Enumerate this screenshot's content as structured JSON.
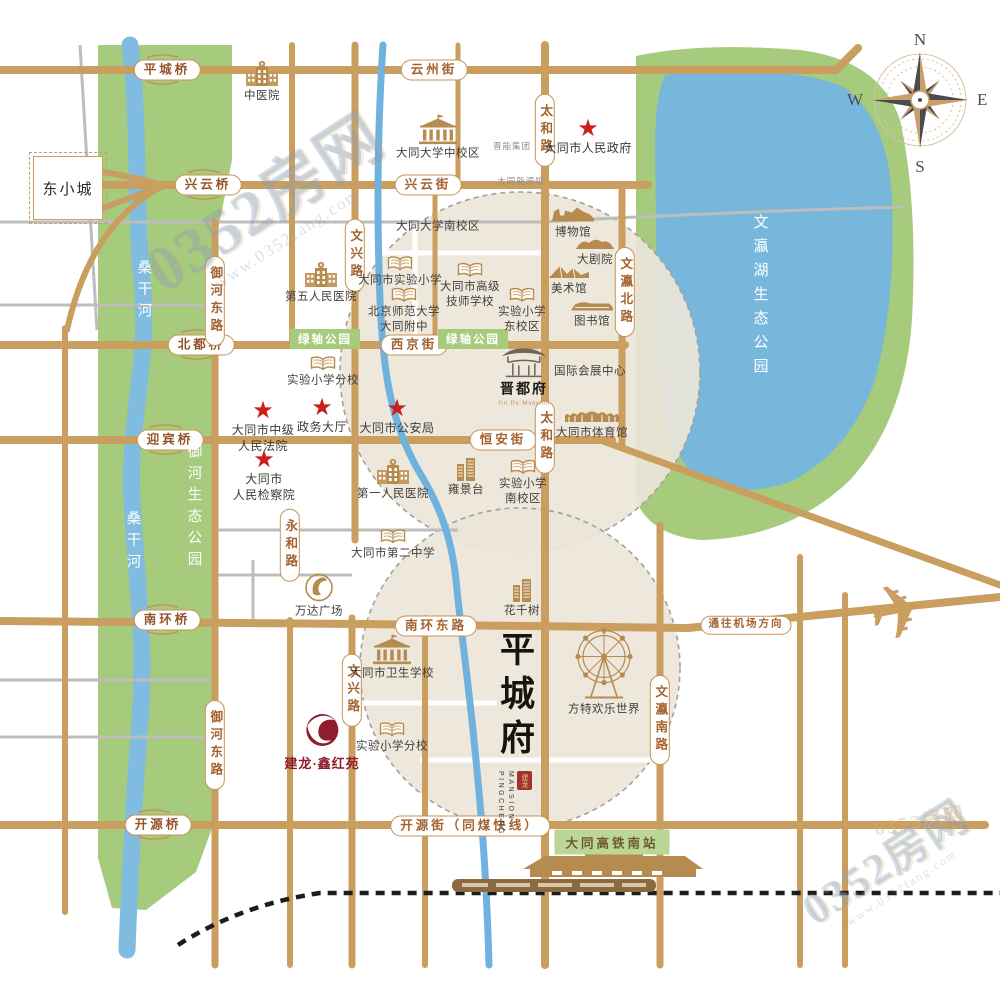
{
  "watermark": {
    "text": "0352房网",
    "url": "www.0352fang.com"
  },
  "compass": {
    "n": "N",
    "e": "E",
    "s": "S",
    "w": "W"
  },
  "area_box": {
    "text": "东小城"
  },
  "pingcheng_logo": {
    "title": "平城府",
    "en_line1": "PINGCHENG",
    "en_line2": "MANSION",
    "seal": "建龙"
  },
  "jianlong_logo": {
    "text": "建龙·鑫红苑"
  },
  "colors": {
    "road_tan": "#C99E5F",
    "road_gray": "#BDBDBD",
    "park_green": "#A6CB7D",
    "water_blue": "#7FBCE0",
    "block_beige": "#EBE5D9",
    "star_red": "#CB1F1C",
    "icon_tan": "#B68B4F",
    "brand_red": "#8F1D2C"
  },
  "map": {
    "labels": [
      {
        "name": "bridge-pingcheng",
        "type": "bridge",
        "text": "平城桥",
        "x": 167,
        "y": 70
      },
      {
        "name": "street-yunzhou",
        "type": "street-h",
        "text": "云州街",
        "x": 434,
        "y": 70
      },
      {
        "name": "bridge-xingyun",
        "type": "bridge",
        "text": "兴云桥",
        "x": 208,
        "y": 185
      },
      {
        "name": "street-xingyun",
        "type": "street-h",
        "text": "兴云街",
        "x": 428,
        "y": 185
      },
      {
        "name": "bridge-beidu",
        "type": "bridge",
        "text": "北都桥",
        "x": 201,
        "y": 345
      },
      {
        "name": "street-xijing",
        "type": "street-h",
        "text": "西京街",
        "x": 414,
        "y": 345
      },
      {
        "name": "bridge-yingbin",
        "type": "bridge",
        "text": "迎宾桥",
        "x": 170,
        "y": 440
      },
      {
        "name": "street-hengan",
        "type": "street-h",
        "text": "恒安街",
        "x": 503,
        "y": 440
      },
      {
        "name": "bridge-nanhuan",
        "type": "bridge",
        "text": "南环桥",
        "x": 167,
        "y": 620
      },
      {
        "name": "street-nanhuan-east",
        "type": "street-h",
        "text": "南环东路",
        "x": 436,
        "y": 626
      },
      {
        "name": "street-to-airport",
        "type": "street-h",
        "cls": "small",
        "text": "通往机场方向",
        "x": 746,
        "y": 625
      },
      {
        "name": "bridge-kaiyuan",
        "type": "bridge",
        "text": "开源桥",
        "x": 158,
        "y": 825
      },
      {
        "name": "street-kaiyuan",
        "type": "street-h",
        "text": "开源街（同煤快线）",
        "x": 470,
        "y": 826
      },
      {
        "name": "road-wenxing-north",
        "type": "street-v",
        "text": "文兴路",
        "x": 355,
        "y": 255
      },
      {
        "name": "road-yuhe-east-north",
        "type": "street-v",
        "text": "御河东路",
        "x": 215,
        "y": 301
      },
      {
        "name": "road-taihe-north",
        "type": "street-v",
        "text": "太和路",
        "x": 545,
        "y": 130
      },
      {
        "name": "road-wenying-north",
        "type": "street-v",
        "text": "文瀛北路",
        "x": 625,
        "y": 292
      },
      {
        "name": "road-yonghe",
        "type": "street-v",
        "text": "永和路",
        "x": 290,
        "y": 545
      },
      {
        "name": "road-taihe-south",
        "type": "street-v",
        "text": "太和路",
        "x": 545,
        "y": 437
      },
      {
        "name": "road-yuhe-east-south",
        "type": "street-v",
        "text": "御河东路",
        "x": 215,
        "y": 745
      },
      {
        "name": "road-wenxing-south",
        "type": "street-v",
        "text": "文兴路",
        "x": 352,
        "y": 690
      },
      {
        "name": "road-wenying-south",
        "type": "street-v",
        "text": "文瀛南路",
        "x": 660,
        "y": 720
      },
      {
        "name": "park-green-axis-west",
        "type": "park-bar",
        "text": "绿轴公园",
        "x": 325,
        "y": 339
      },
      {
        "name": "park-green-axis-east",
        "type": "park-bar",
        "text": "绿轴公园",
        "x": 473,
        "y": 339
      },
      {
        "name": "station-datong-south",
        "type": "station-bar",
        "text": "大同高铁南站",
        "x": 612,
        "y": 842
      },
      {
        "name": "river-sanggan-north",
        "type": "vtext",
        "text": "桑干河",
        "x": 144,
        "y": 292
      },
      {
        "name": "river-sanggan-south",
        "type": "vtext",
        "text": "桑干河",
        "x": 133,
        "y": 543
      },
      {
        "name": "park-yuhe-eco",
        "type": "vtext",
        "text": "御河生态公园",
        "x": 194,
        "y": 508
      },
      {
        "name": "park-wenyinghu-eco",
        "type": "vtext",
        "cls": "lake",
        "text": "文瀛湖生态公园",
        "x": 760,
        "y": 298
      },
      {
        "name": "jinneng-group",
        "type": "gray-text",
        "text": "晋能集团",
        "x": 512,
        "y": 146
      },
      {
        "name": "datong-energy-hall",
        "type": "gray-text",
        "text": "大同能源馆",
        "x": 521,
        "y": 181
      },
      {
        "name": "city-government",
        "type": "star",
        "text": "大同市人民政府",
        "x": 588,
        "y": 138
      },
      {
        "name": "intermediate-court",
        "type": "star",
        "text": "大同市中级\n人民法院",
        "x": 263,
        "y": 428
      },
      {
        "name": "government-affairs-hall",
        "type": "star",
        "text": "政务大厅",
        "x": 322,
        "y": 417
      },
      {
        "name": "public-security-bureau",
        "type": "star",
        "text": "大同市公安局",
        "x": 397,
        "y": 418
      },
      {
        "name": "peoples-procuratorate",
        "type": "star",
        "text": "大同市\n人民检察院",
        "x": 264,
        "y": 477
      },
      {
        "name": "tcm-hospital",
        "type": "poi",
        "icon": "hospital",
        "text": "中医院",
        "x": 262,
        "y": 82
      },
      {
        "name": "datong-univ-middle-campus",
        "type": "poi",
        "icon": "university",
        "text": "大同大学中校区",
        "x": 438,
        "y": 138
      },
      {
        "name": "datong-univ-south-campus",
        "type": "poi",
        "text": "大同大学南校区",
        "x": 438,
        "y": 226
      },
      {
        "name": "fifth-peoples-hospital",
        "type": "poi",
        "icon": "hospital",
        "text": "第五人民医院",
        "x": 321,
        "y": 283
      },
      {
        "name": "datong-experimental-primary",
        "type": "poi",
        "icon": "book",
        "text": "大同市实验小学",
        "x": 400,
        "y": 272
      },
      {
        "name": "bnu-datong-affiliated",
        "type": "poi",
        "icon": "book",
        "text": "北京师范大学\n大同附中",
        "x": 404,
        "y": 311
      },
      {
        "name": "senior-technician-school",
        "type": "poi",
        "icon": "book",
        "text": "大同市高级\n技师学校",
        "x": 470,
        "y": 286
      },
      {
        "name": "experimental-primary-east",
        "type": "poi",
        "icon": "book",
        "text": "实验小学\n东校区",
        "x": 522,
        "y": 311
      },
      {
        "name": "experimental-primary-branch-n",
        "type": "poi",
        "icon": "book",
        "text": "实验小学分校",
        "x": 323,
        "y": 372
      },
      {
        "name": "museum",
        "type": "poi",
        "icon": "museum",
        "text": "博物馆",
        "x": 573,
        "y": 222
      },
      {
        "name": "grand-theater",
        "type": "poi",
        "icon": "theater",
        "text": "大剧院",
        "x": 595,
        "y": 252
      },
      {
        "name": "art-gallery",
        "type": "poi",
        "icon": "gallery",
        "text": "美术馆",
        "x": 569,
        "y": 280
      },
      {
        "name": "library",
        "type": "poi",
        "icon": "library",
        "text": "图书馆",
        "x": 592,
        "y": 315
      },
      {
        "name": "intl-exhibition-center",
        "type": "poi",
        "text": "国际会展中心",
        "x": 590,
        "y": 371
      },
      {
        "name": "jindufu",
        "type": "poi",
        "cls": "gate",
        "icon": "gate",
        "text": "晋都府",
        "sub": "Jin Du Mansion",
        "x": 524,
        "y": 375
      },
      {
        "name": "sports-center",
        "type": "poi",
        "icon": "stadium",
        "text": "大同市体育馆",
        "x": 592,
        "y": 425
      },
      {
        "name": "first-peoples-hospital",
        "type": "poi",
        "icon": "hospital",
        "text": "第一人民医院",
        "x": 393,
        "y": 480
      },
      {
        "name": "yongjingtai",
        "type": "poi",
        "icon": "tower",
        "text": "雍景台",
        "x": 466,
        "y": 477
      },
      {
        "name": "experimental-primary-south",
        "type": "poi",
        "icon": "book",
        "text": "实验小学\n南校区",
        "x": 523,
        "y": 483
      },
      {
        "name": "datong-no2-middle-school",
        "type": "poi",
        "icon": "book",
        "text": "大同市第二中学",
        "x": 393,
        "y": 545
      },
      {
        "name": "wanda-plaza",
        "type": "poi",
        "icon": "wanda",
        "text": "万达广场",
        "x": 319,
        "y": 596
      },
      {
        "name": "huaqianshu",
        "type": "poi",
        "icon": "tower",
        "text": "花千树",
        "x": 522,
        "y": 598
      },
      {
        "name": "datong-health-school",
        "type": "poi",
        "icon": "university",
        "text": "大同市卫生学校",
        "x": 392,
        "y": 658
      },
      {
        "name": "experimental-primary-branch-s",
        "type": "poi",
        "icon": "book",
        "text": "实验小学分校",
        "x": 392,
        "y": 738
      },
      {
        "name": "fangte-happy-world",
        "type": "poi",
        "icon": "ferris",
        "text": "方特欢乐世界",
        "x": 604,
        "y": 672
      },
      {
        "name": "airplane",
        "type": "plane",
        "x": 900,
        "y": 613
      }
    ]
  }
}
